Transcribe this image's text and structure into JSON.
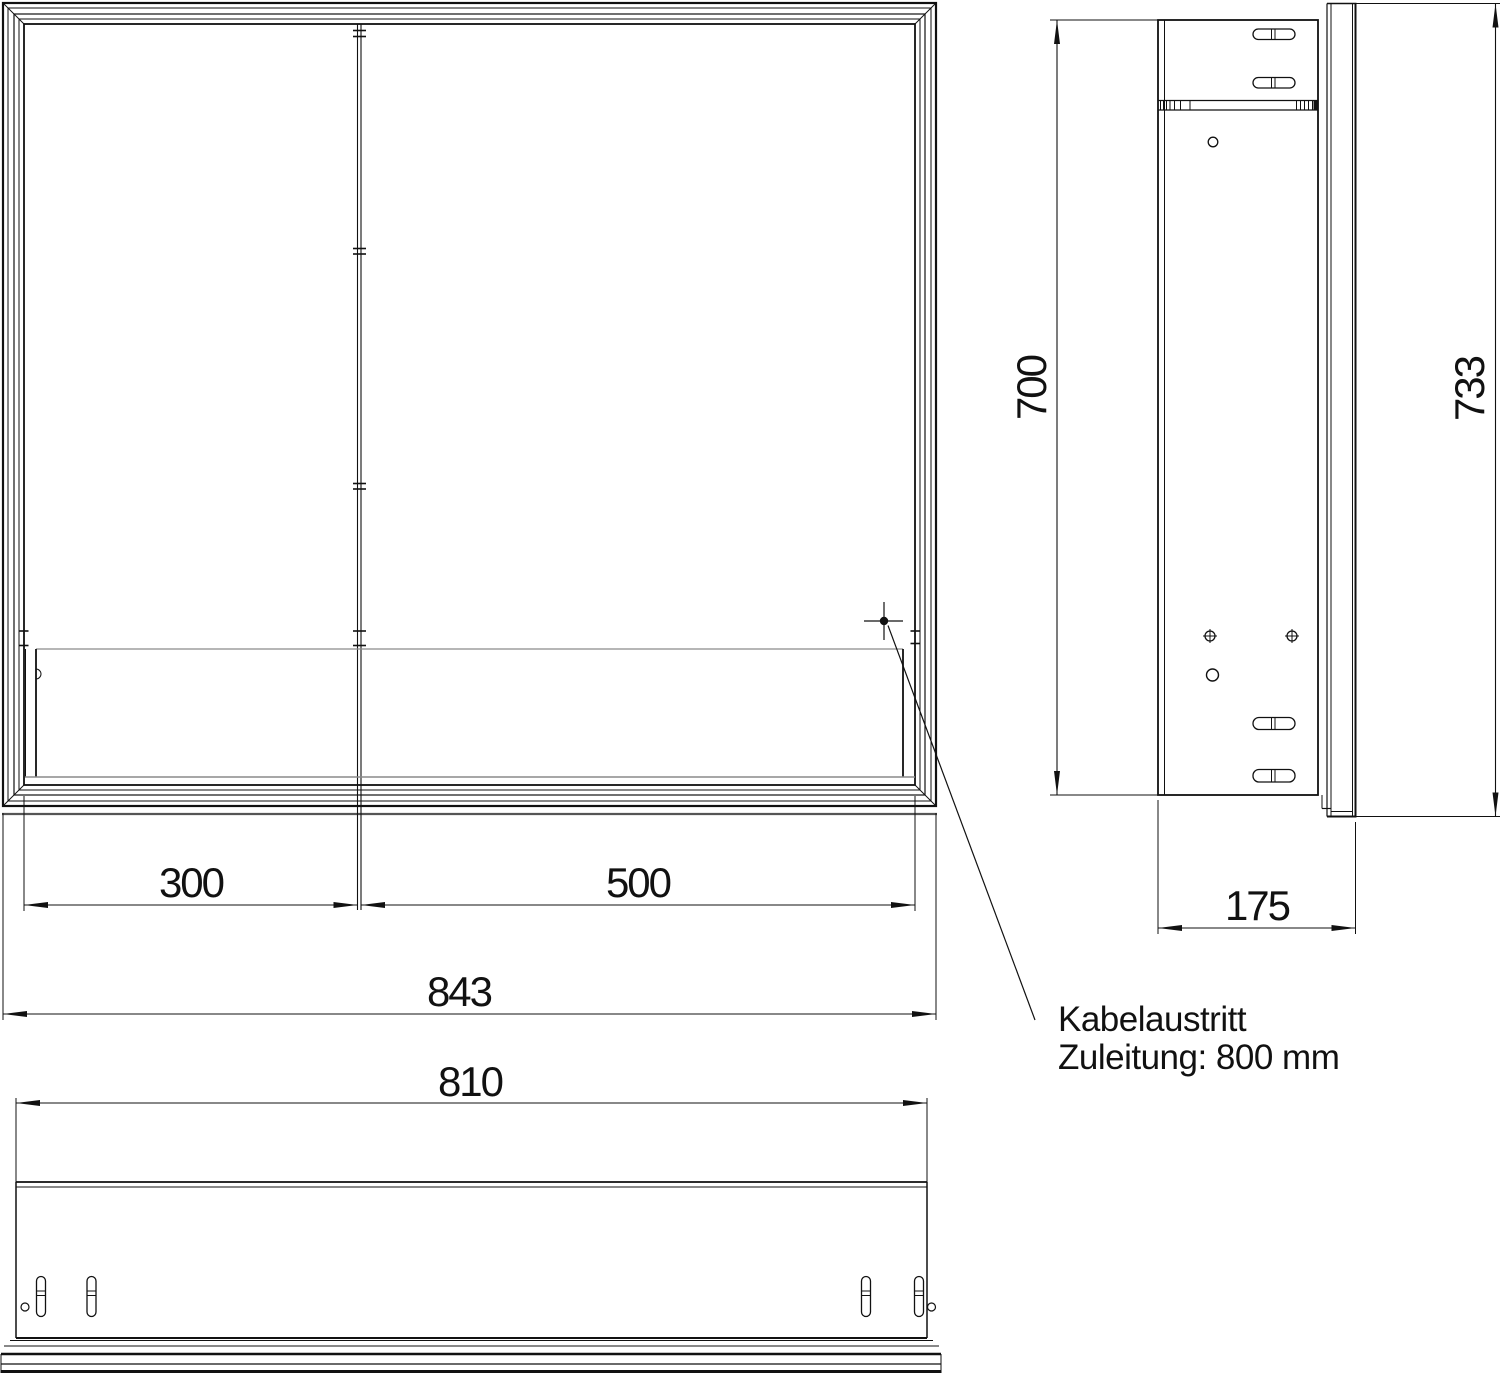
{
  "dimensions": {
    "left_door_width": "300",
    "right_door_width": "500",
    "overall_width": "843",
    "body_width": "810",
    "carcass_height": "700",
    "overall_height": "733",
    "depth": "175"
  },
  "annotation": {
    "line1": "Kabelaustritt",
    "line2": "Zuleitung: 800 mm"
  },
  "colors": {
    "line": "#111111",
    "light_line": "#8a8a8a",
    "background": "#ffffff"
  }
}
